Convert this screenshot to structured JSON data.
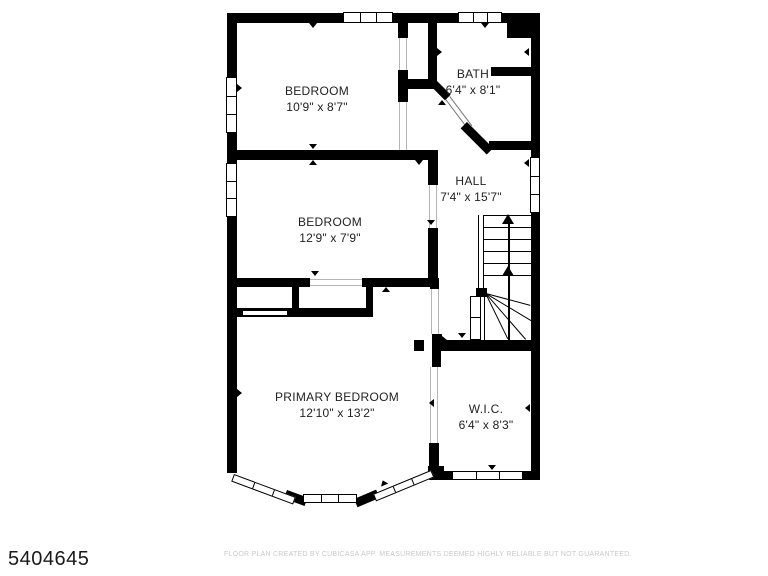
{
  "plan": {
    "background": "#ffffff",
    "wall_color": "#000000",
    "rooms": [
      {
        "id": "bedroom-top",
        "name": "BEDROOM",
        "dims": "10'9\" x 8'7\""
      },
      {
        "id": "bath",
        "name": "BATH",
        "dims": "6'4\" x 8'1\""
      },
      {
        "id": "bedroom-middle",
        "name": "BEDROOM",
        "dims": "12'9\" x 7'9\""
      },
      {
        "id": "hall",
        "name": "HALL",
        "dims": "7'4\" x 15'7\""
      },
      {
        "id": "primary-bedroom",
        "name": "PRIMARY BEDROOM",
        "dims": "12'10\" x 13'2\""
      },
      {
        "id": "wic",
        "name": "W.I.C.",
        "dims": "6'4\" x 8'3\""
      }
    ]
  },
  "footer": {
    "listing_id": "5404645",
    "disclaimer": "FLOOR PLAN CREATED BY CUBICASA APP. MEASUREMENTS DEEMED HIGHLY RELIABLE BUT NOT GUARANTEED."
  }
}
